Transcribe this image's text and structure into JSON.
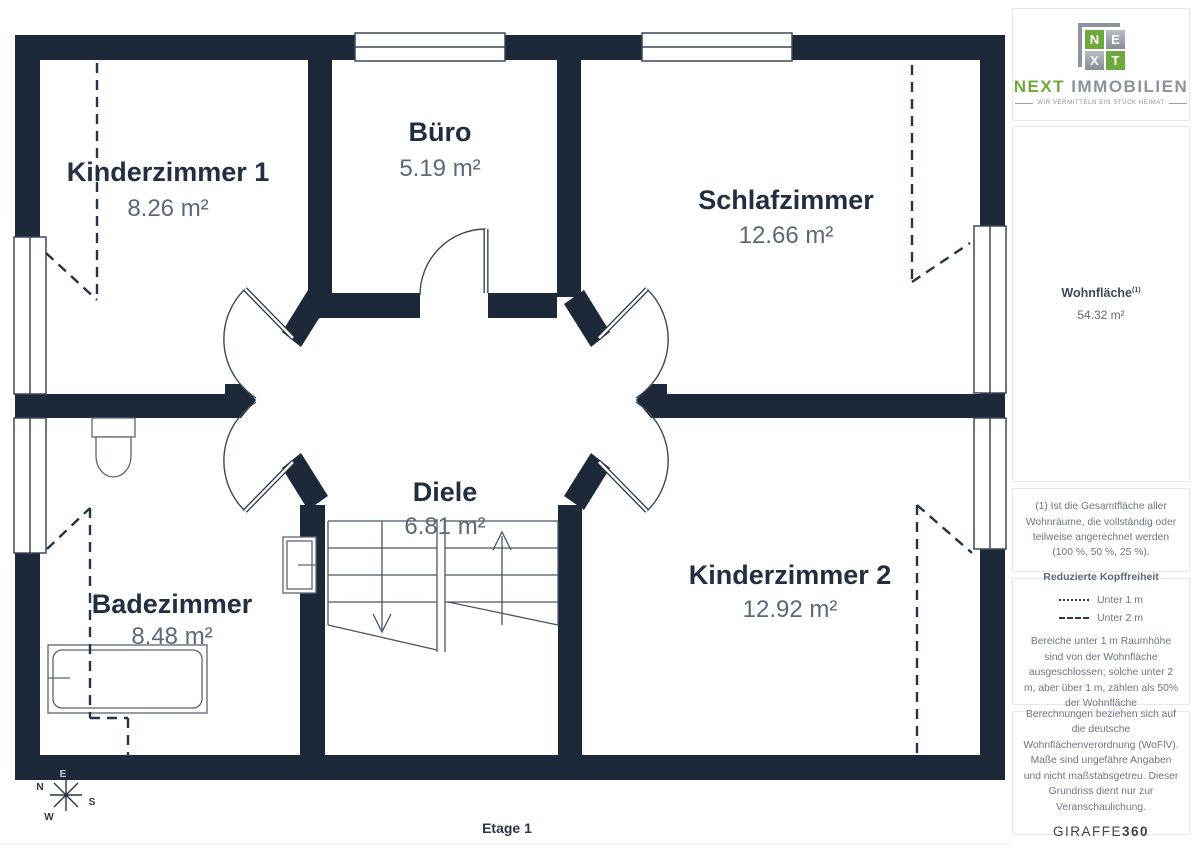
{
  "floor_plan": {
    "level_label": "Etage 1",
    "rooms": [
      {
        "name": "Kinderzimmer 1",
        "area": "8.26 m²"
      },
      {
        "name": "Büro",
        "area": "5.19 m²"
      },
      {
        "name": "Schlafzimmer",
        "area": "12.66 m²"
      },
      {
        "name": "Diele",
        "area": "6.81 m²"
      },
      {
        "name": "Badezimmer",
        "area": "8.48 m²"
      },
      {
        "name": "Kinderzimmer 2",
        "area": "12.92 m²"
      }
    ],
    "compass": {
      "north": "N",
      "east": "E",
      "south": "S",
      "west": "W"
    }
  },
  "sidebar": {
    "logo": {
      "tiles": [
        "N",
        "E",
        "X",
        "T"
      ],
      "brand_next": "NEXT",
      "brand_immobilien": "IMMOBILIEN",
      "tagline": "WIR VERMITTELN EIN STÜCK HEIMAT"
    },
    "area_summary": {
      "label": "Wohnfläche",
      "label_sup": "(1)",
      "value": "54.32 m²"
    },
    "footnote": "(1) Ist die Gesamtfläche aller Wohnräume, die vollständig oder teilweise angerechnet werden (100 %, 50 %, 25 %).",
    "headroom": {
      "title": "Reduzierte Kopffreiheit",
      "legend": [
        {
          "style": "dotted",
          "label": "Unter 1 m"
        },
        {
          "style": "dashed",
          "label": "Unter 2 m"
        }
      ],
      "note": "Bereiche unter 1 m Raumhöhe sind von der Wohnfläche ausgeschlossen; solche unter 2 m, aber über 1 m, zählen als 50% der Wohnfläche"
    },
    "disclaimer": "Berechnungen beziehen sich auf die deutsche Wohnflächenverordnung (WoFlV). Maße sind ungefähre Angaben und nicht maßstabsgetreu. Dieser Grundriss dient nur zur Veranschaulichung.",
    "vendor": {
      "name": "GIRAFFE",
      "suffix": "360"
    }
  },
  "colors": {
    "wall_navy": "#1d2838",
    "logo_green": "#6fa83c",
    "room_label": "#232e42",
    "area_label": "#5c6878",
    "muted_text": "#6b7684",
    "card_border": "#e4e7eb"
  }
}
